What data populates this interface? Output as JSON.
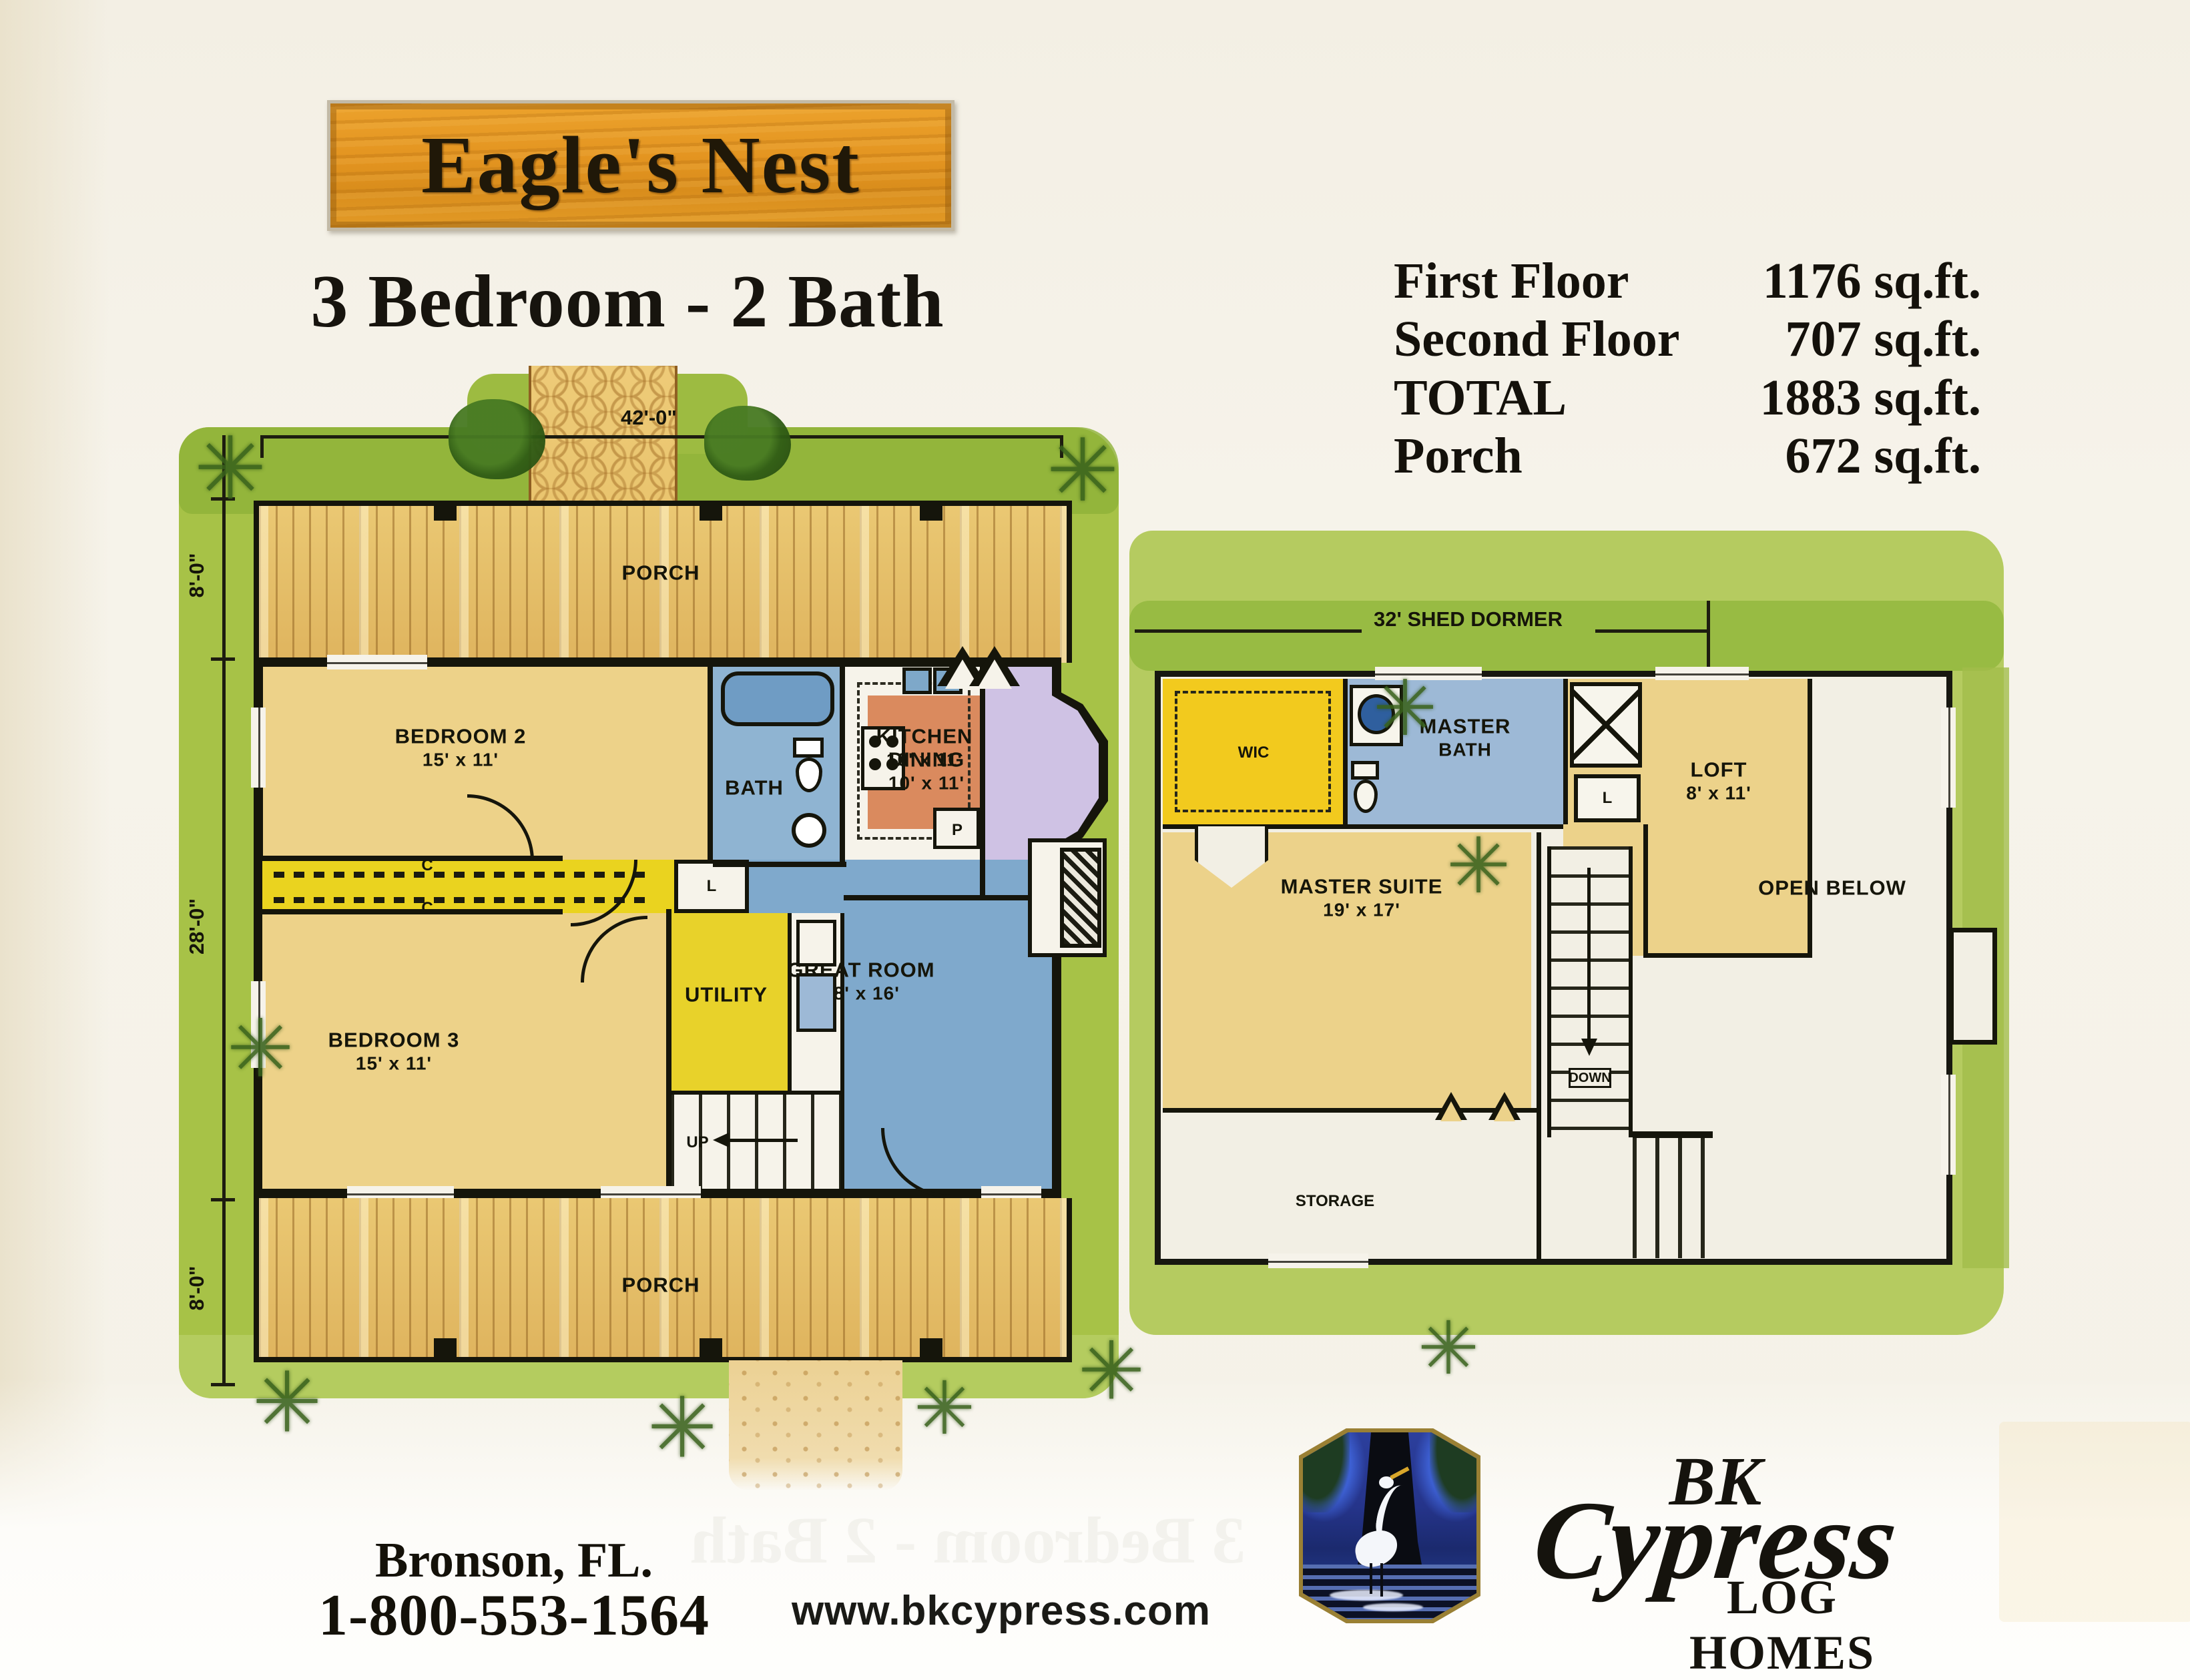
{
  "page": {
    "title": "Eagle's Nest",
    "subtitle": "3 Bedroom  -  2 Bath",
    "bleed_through": "3 Bedroom - 2 Bath"
  },
  "stats": {
    "rows": [
      {
        "label": "First Floor",
        "value": "1176 sq.ft."
      },
      {
        "label": "Second Floor",
        "value": "707 sq.ft."
      },
      {
        "label": "TOTAL",
        "value": "1883 sq.ft."
      },
      {
        "label": "Porch",
        "value": "672 sq.ft."
      }
    ]
  },
  "floor1": {
    "dim_width": "42'-0\"",
    "dim_porch_top": "8'-0\"",
    "dim_depth": "28'-0\"",
    "dim_porch_bottom": "8'-0\"",
    "porch_top": "PORCH",
    "porch_bottom": "PORCH",
    "rooms": {
      "bedroom2": {
        "name": "BEDROOM 2",
        "size": "15' x 11'"
      },
      "bath": {
        "name": "BATH"
      },
      "kitchen": {
        "name": "KITCHEN",
        "size": "10' x 11'"
      },
      "dining": {
        "name": "DINING",
        "size": "10' x 11'"
      },
      "great_room": {
        "name": "GREAT ROOM",
        "size": "18' x 16'"
      },
      "bedroom3": {
        "name": "BEDROOM 3",
        "size": "15' x 11'"
      },
      "utility": {
        "name": "UTILITY"
      },
      "closet1": "C",
      "closet2": "C",
      "linen": "L",
      "pantry": "P",
      "stairs": "UP"
    }
  },
  "floor2": {
    "dim_dormer": "32'  SHED DORMER",
    "rooms": {
      "wic": "WIC",
      "master_bath_line1": "MASTER",
      "master_bath_line2": "BATH",
      "loft": {
        "name": "LOFT",
        "size": "8' x 11'"
      },
      "master_suite": {
        "name": "MASTER SUITE",
        "size": "19' x 17'"
      },
      "open_below": "OPEN BELOW",
      "stairs": "DOWN",
      "storage": "STORAGE",
      "linen": "L"
    }
  },
  "footer": {
    "city": "Bronson, FL.",
    "phone": "1-800-553-1564",
    "website": "www.bkcypress.com",
    "logo": {
      "bk": "BK",
      "cypress": "Cypress",
      "tagline": "LOG HOMES"
    }
  },
  "colors": {
    "sign_wood": "#e39420",
    "lawn": "#a7c247",
    "porch_wood": "#eac873",
    "room_tan": "#edd289",
    "bath_blue": "#8fb4d2",
    "great_room_blue": "#7fa9cc",
    "dining_lavender": "#cfc2e4",
    "kitchen_orange": "#da8a5e",
    "utility_yellow": "#e8d22a",
    "wic_yellow": "#f2ca1e",
    "wall_black": "#15150b",
    "logo_blue": "#25348a"
  }
}
